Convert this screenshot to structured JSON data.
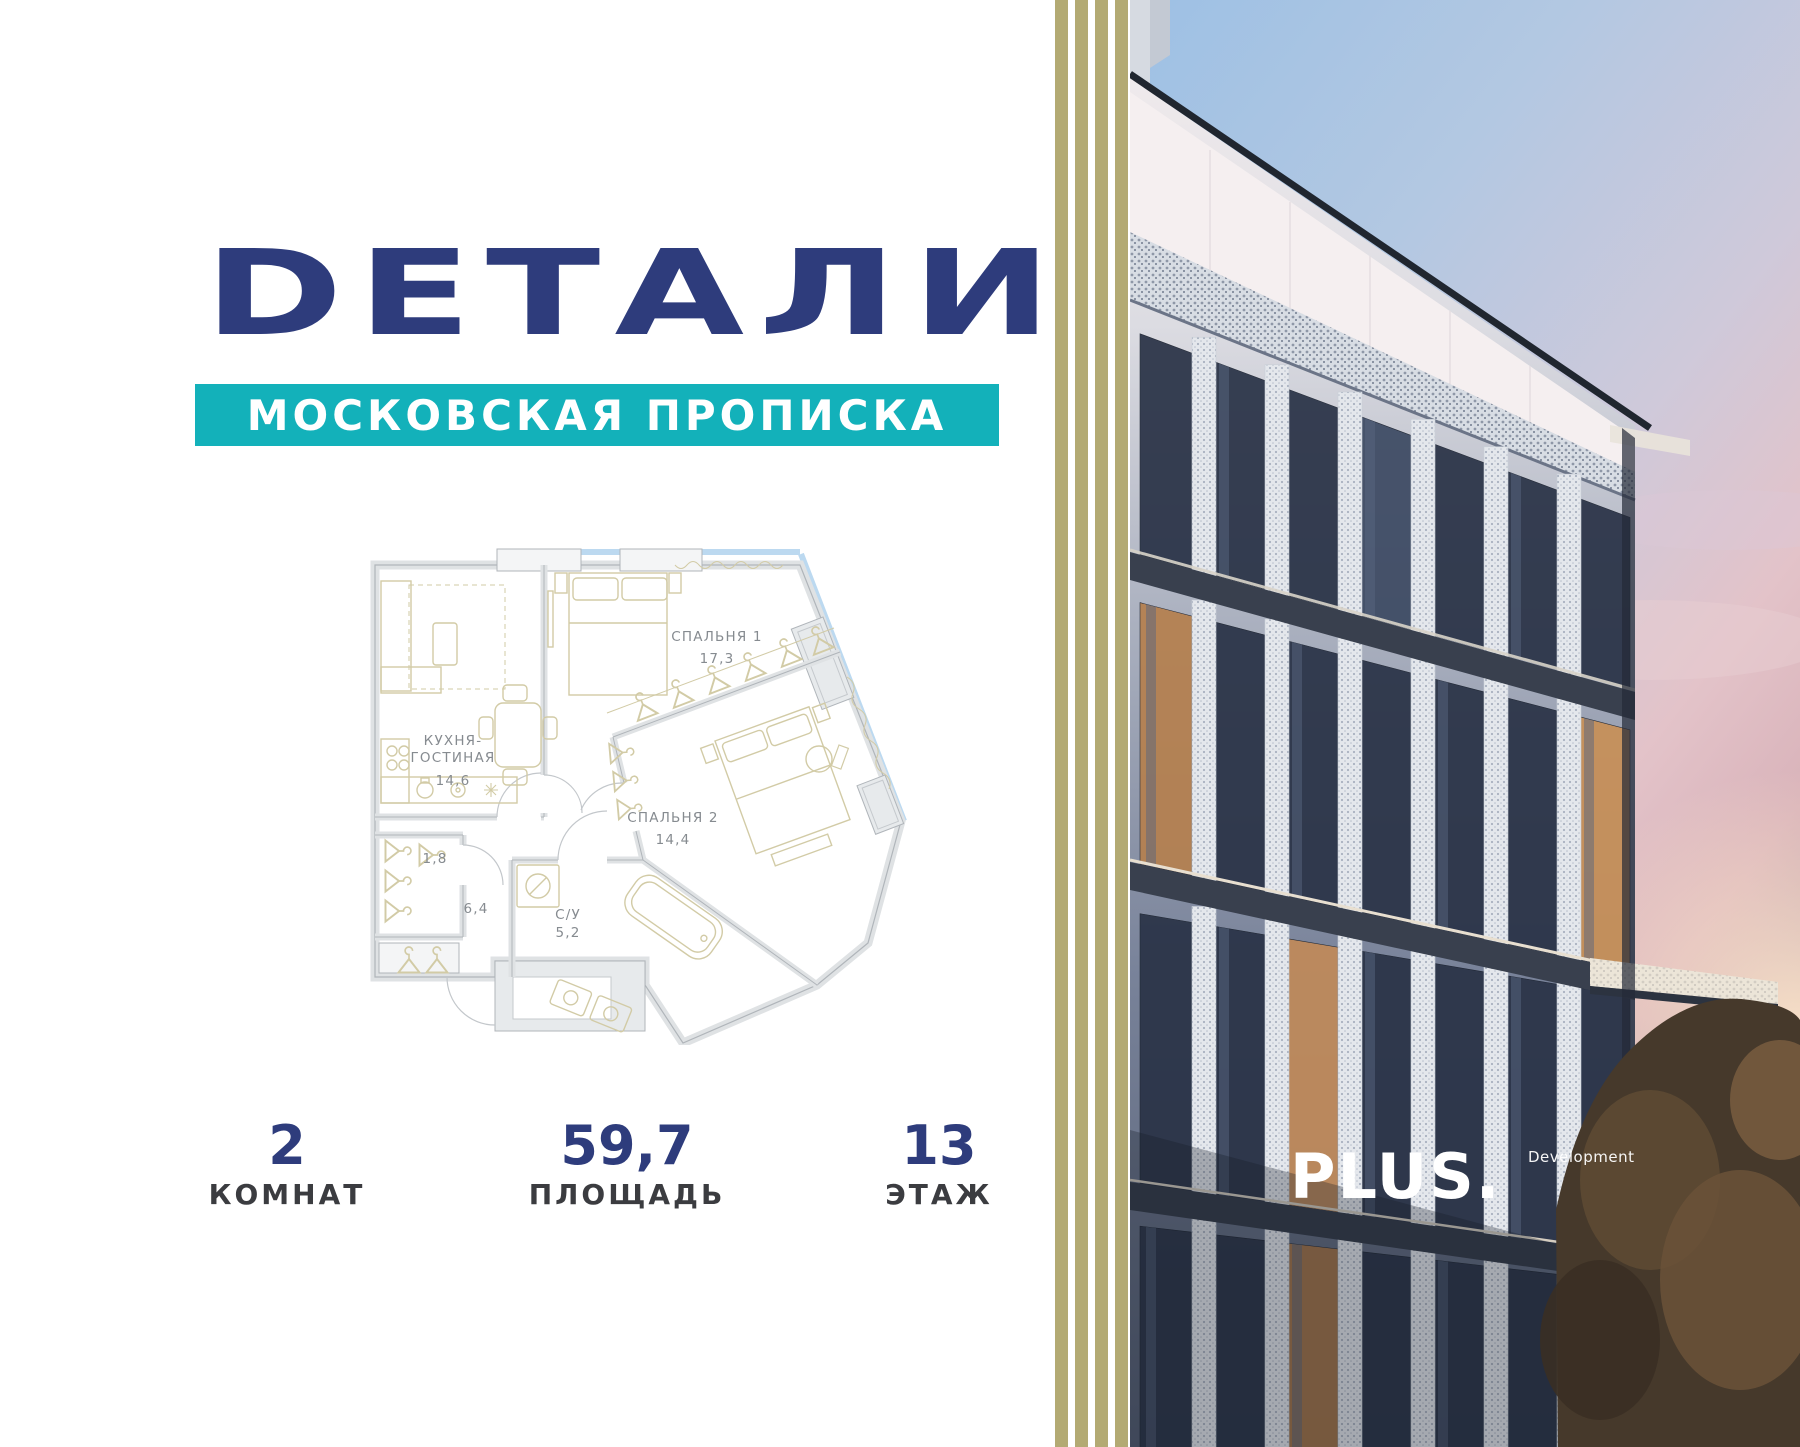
{
  "brand": {
    "title": "DЕТАЛИ",
    "subtitle": "МОСКОВСКАЯ ПРОПИСКА"
  },
  "developer": {
    "name": "PLUS.",
    "label": "Development"
  },
  "floorplan": {
    "rooms": [
      {
        "name": "СПАЛЬНЯ 1",
        "area": "17,3"
      },
      {
        "name_line1": "КУХНЯ-",
        "name_line2": "ГОСТИНАЯ",
        "area": "14,6"
      },
      {
        "name": "СПАЛЬНЯ 2",
        "area": "14,4"
      },
      {
        "name": "",
        "area": "1,8"
      },
      {
        "name": "",
        "area": "6,4"
      },
      {
        "name": "С/У",
        "area": "5,2"
      }
    ]
  },
  "stats": [
    {
      "value": "2",
      "label": "КОМНАТ"
    },
    {
      "value": "59,7",
      "label": "ПЛОЩАДЬ"
    },
    {
      "value": "13",
      "label": "ЭТАЖ"
    }
  ],
  "colors": {
    "navy": "#2e3c7c",
    "teal": "#13b1ba",
    "gold": "#b3aa73",
    "plan_furniture": "#d2cba6",
    "plan_wall": "#b0b5ba",
    "window_blue": "#bcd9f0"
  }
}
